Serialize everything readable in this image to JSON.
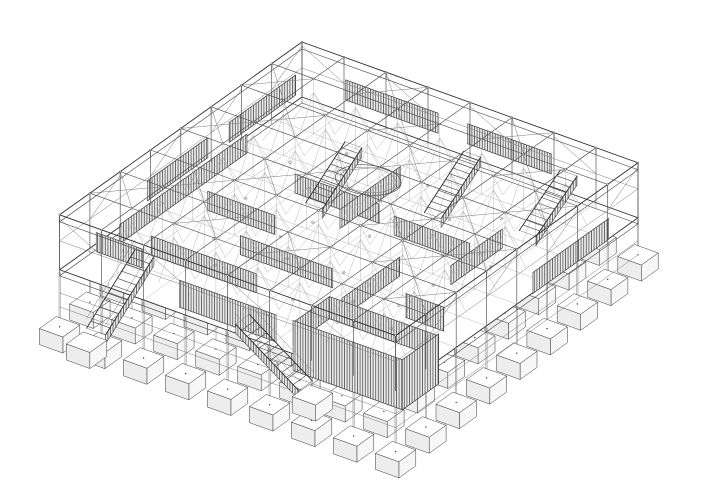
{
  "meta": {
    "title": "Axonometric structural wireframe drawing of a single-storey pavilion",
    "drawing_type": "architectural axonometric line drawing",
    "background": "#ffffff"
  },
  "drawing": {
    "title": "Axonometric structural frame: 9x9 column grid, braced roof, corrugated room walls, stairs and pad footings",
    "palette": {
      "line_primary": "#2e2e2e",
      "line_secondary": "#4d4d4d",
      "line_light": "#7c7c7c",
      "line_faint": "#a4a4a4",
      "hatch_line": "#474747",
      "hatch_bg": "#eaeaea",
      "paper": "#ffffff"
    },
    "projection": {
      "origin": [
        302,
        42
      ],
      "axisA": [
        42,
        15.1
      ],
      "axisB": [
        -30.3,
        21.6
      ],
      "bays": 8
    },
    "levels": {
      "roof": 0,
      "fascia": 7,
      "midrail": 26,
      "deck": 55,
      "slab_bottom": 61,
      "underbeam1": 78,
      "underbeam2": 92
    },
    "ground": {
      "base": 88,
      "slopeU": 0.5,
      "slopeV": 3.0
    },
    "footing": {
      "half": 0.28,
      "height": 16
    },
    "roof_x_braces": [
      [
        0,
        1
      ],
      [
        1,
        2
      ],
      [
        2,
        0
      ],
      [
        3,
        1
      ],
      [
        5,
        0
      ],
      [
        6,
        1
      ],
      [
        7,
        2
      ],
      [
        1,
        5
      ],
      [
        2,
        6
      ],
      [
        4,
        6
      ],
      [
        6,
        5
      ],
      [
        3,
        3
      ],
      [
        4,
        2
      ],
      [
        5,
        4
      ],
      [
        2,
        4
      ],
      [
        6,
        3
      ],
      [
        0,
        6
      ],
      [
        7,
        6
      ],
      [
        0,
        3
      ],
      [
        7,
        4
      ]
    ],
    "trusses": {
      "rowsV": [
        1,
        2,
        3,
        4,
        5,
        6,
        7
      ],
      "rowsU": [
        1,
        2,
        3,
        4,
        5,
        6,
        7
      ],
      "span": [
        0.5,
        7.5
      ],
      "step": 0.5,
      "zHigh": 14,
      "zLow": 48
    },
    "walls": [
      {
        "u": 0.5,
        "v": 0.9,
        "dir": "B",
        "len": 2.2,
        "top": 6,
        "bot": 26
      },
      {
        "u": 0.5,
        "v": 3.8,
        "dir": "B",
        "len": 2.0,
        "top": 6,
        "bot": 26
      },
      {
        "u": 1.4,
        "v": 0.5,
        "dir": "A",
        "len": 2.2,
        "top": 6,
        "bot": 26
      },
      {
        "u": 4.3,
        "v": 0.5,
        "dir": "A",
        "len": 2.0,
        "top": 6,
        "bot": 26
      },
      {
        "u": 0.35,
        "v": 2.3,
        "dir": "B",
        "len": 4.2,
        "top": 37,
        "bot": 56
      },
      {
        "u": 1.1,
        "v": 6.5,
        "dir": "A",
        "len": 2.5,
        "top": 37,
        "bot": 56
      },
      {
        "u": 2.35,
        "v": 7.3,
        "dir": "A",
        "len": 2.3,
        "top": 45,
        "bot": 72
      },
      {
        "u": 3.5,
        "v": 1.6,
        "dir": "B",
        "len": 2.0,
        "top": 37,
        "bot": 56
      },
      {
        "u": 2.0,
        "v": 3.0,
        "dir": "A",
        "len": 2.0,
        "top": 37,
        "bot": 56
      },
      {
        "u": 4.5,
        "v": 3.2,
        "dir": "A",
        "len": 1.8,
        "top": 37,
        "bot": 56
      },
      {
        "u": 1.0,
        "v": 4.5,
        "dir": "A",
        "len": 1.6,
        "top": 37,
        "bot": 56
      },
      {
        "u": 5.5,
        "v": 4.4,
        "dir": "B",
        "len": 1.9,
        "top": 37,
        "bot": 56
      },
      {
        "u": 2.5,
        "v": 5.5,
        "dir": "A",
        "len": 2.2,
        "top": 37,
        "bot": 56
      },
      {
        "u": 6.5,
        "v": 2.4,
        "dir": "B",
        "len": 1.7,
        "top": 37,
        "bot": 56
      },
      {
        "u": 7.95,
        "v": 0.9,
        "dir": "B",
        "len": 2.5,
        "top": 37,
        "bot": 58
      },
      {
        "u": 0.15,
        "v": 7.0,
        "dir": "A",
        "len": 1.1,
        "top": 37,
        "bot": 56
      },
      {
        "u": 6.3,
        "v": 5.3,
        "dir": "A",
        "len": 0.9,
        "top": 42,
        "bot": 66
      },
      {
        "u": 5.2,
        "v": 6.3,
        "dir": "A",
        "len": 2.6,
        "top": 40,
        "bot": 62
      },
      {
        "u": 5.2,
        "v": 6.3,
        "dir": "B",
        "len": 1.2,
        "top": 40,
        "bot": 62
      },
      {
        "u": 5.2,
        "v": 7.5,
        "dir": "A",
        "len": 2.6,
        "top": 38,
        "bot": 88
      },
      {
        "u": 7.8,
        "v": 6.3,
        "dir": "B",
        "len": 1.2,
        "top": 38,
        "bot": 88
      }
    ],
    "stairs": [
      {
        "u": 0.75,
        "v": 6.55,
        "dir": "B",
        "len": 1.6,
        "w": 0.45,
        "ext": true
      },
      {
        "u": 4.0,
        "v": 7.28,
        "dir": "A",
        "len": 1.5,
        "w": 0.45,
        "ext": true
      },
      {
        "u": 2.41,
        "v": 1.92,
        "dir": "B",
        "len": 1.3,
        "w": 0.4,
        "z0": 22
      },
      {
        "u": 4.5,
        "v": 0.9,
        "dir": "B",
        "len": 1.3,
        "w": 0.4,
        "z0": 22
      },
      {
        "u": 6.4,
        "v": 0.35,
        "dir": "B",
        "len": 1.35,
        "w": 0.4,
        "z0": 24
      }
    ],
    "ellipse": {
      "u": 2.89,
      "v": 1.82,
      "z": 55,
      "rx": 33,
      "ry": 15,
      "rx2": 28,
      "ry2": 12.5,
      "rot": 6
    },
    "furniture": [
      [
        1.3,
        2.2
      ],
      [
        2.2,
        2.8
      ],
      [
        3.6,
        2.4
      ],
      [
        4.2,
        3.6
      ],
      [
        5.1,
        2.2
      ],
      [
        5.8,
        3.4
      ],
      [
        6.3,
        4.4
      ],
      [
        2.8,
        4.6
      ],
      [
        3.4,
        5.2
      ],
      [
        4.6,
        5.0
      ],
      [
        5.4,
        5.8
      ],
      [
        1.8,
        5.4
      ],
      [
        2.4,
        6.2
      ],
      [
        3.2,
        6.6
      ],
      [
        4.4,
        6.4
      ],
      [
        5.6,
        6.6
      ],
      [
        6.2,
        5.4
      ],
      [
        1.4,
        3.8
      ],
      [
        6.8,
        3.2
      ],
      [
        3.0,
        3.8
      ],
      [
        4.0,
        1.4
      ],
      [
        5.9,
        1.6
      ],
      [
        2.0,
        1.3
      ],
      [
        6.6,
        6.2
      ]
    ]
  }
}
